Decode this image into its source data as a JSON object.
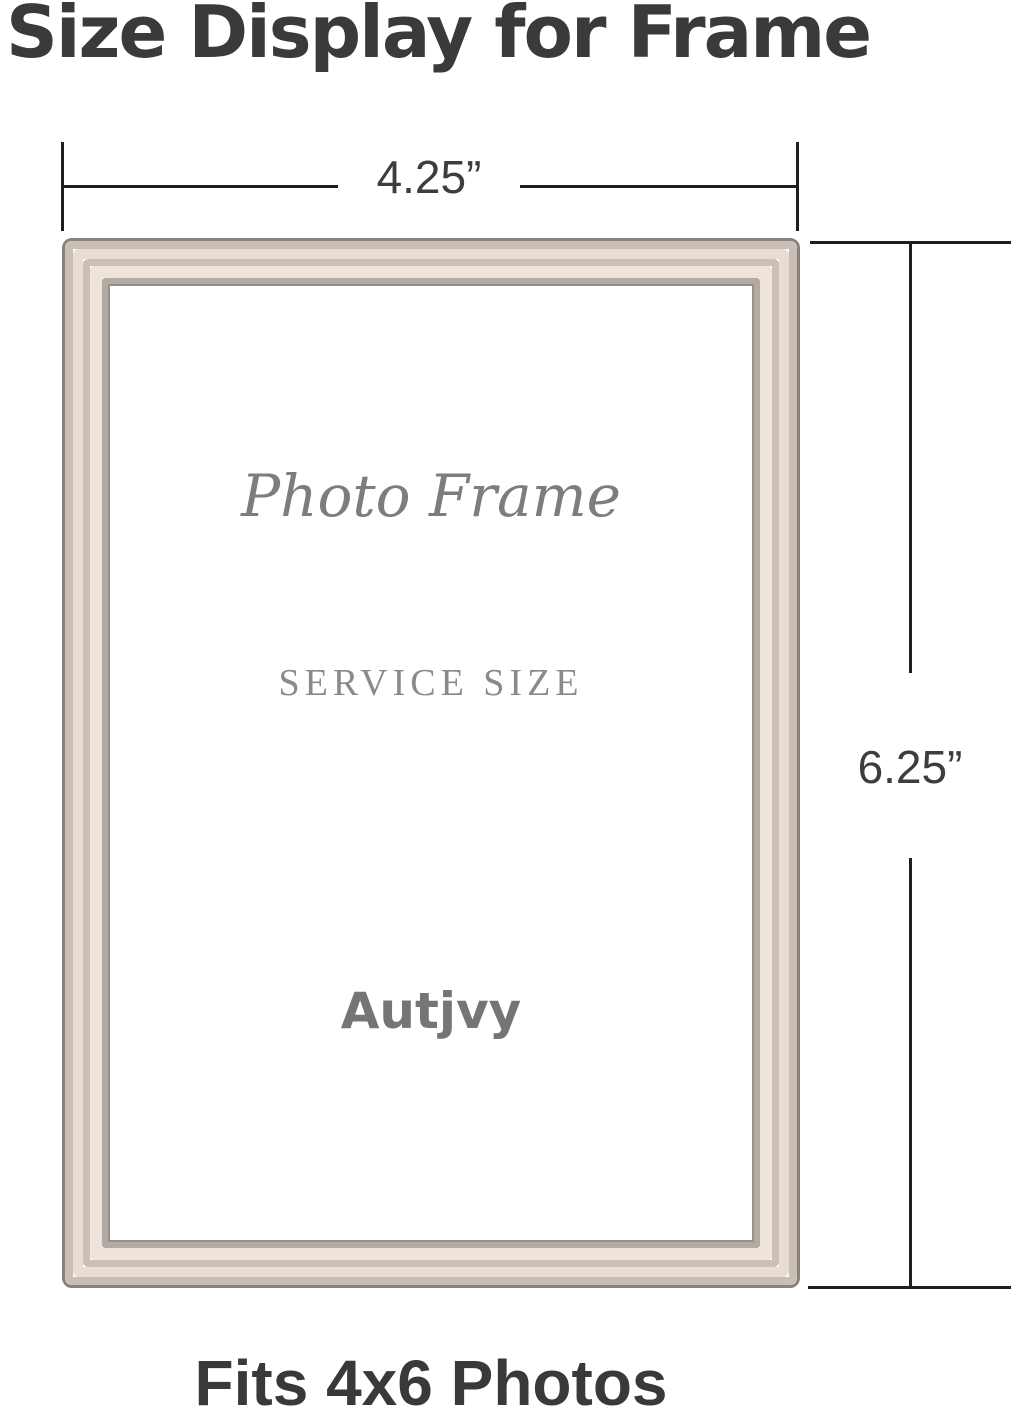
{
  "title": "Size Display for Frame",
  "dimensions": {
    "width_label": "4.25”",
    "height_label": "6.25”"
  },
  "frame": {
    "script_text": "Photo Frame",
    "service_text": "SERVICE SIZE",
    "brand": "Autjvy"
  },
  "caption": "Fits 4x6 Photos",
  "colors": {
    "background": "#ffffff",
    "title_text": "#3a3a3a",
    "dimension_line": "#1f1f1f",
    "dimension_label": "#3d3d3d",
    "interior_text_gray": "#7d7d7d",
    "service_text_gray": "#8a8a8a",
    "brand_text_gray": "#757575",
    "caption_text": "#393939",
    "frame_band_1": "#8a8179",
    "frame_band_2": "#c9beb5",
    "frame_band_3": "#e8ddd5",
    "frame_band_4": "#cbc0b7",
    "frame_band_5": "#eee4db",
    "frame_band_6": "#b3aaa2",
    "frame_band_7": "#978f88"
  }
}
